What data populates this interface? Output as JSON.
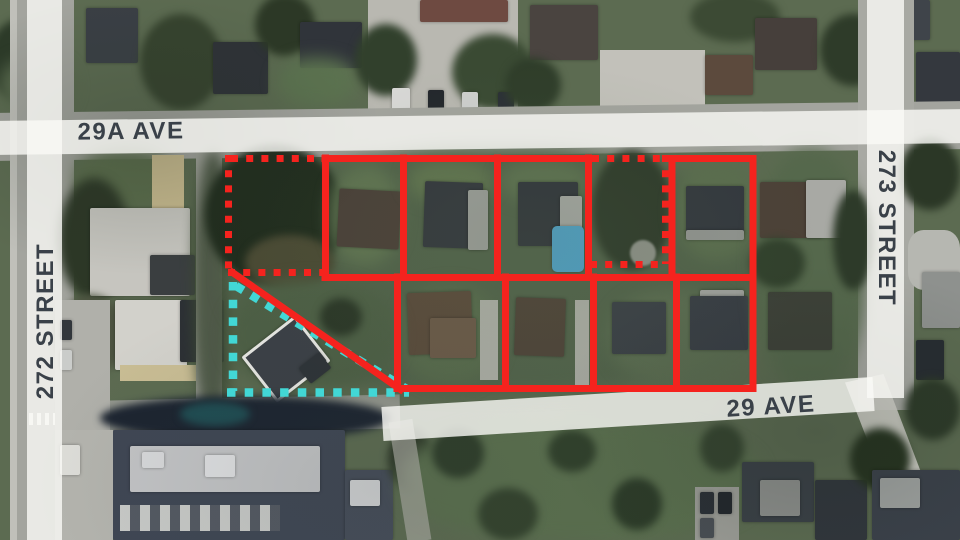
{
  "map": {
    "description": "Satellite aerial view of residential blocks with land-assembly lot outlines",
    "street_labels": {
      "top": "29A AVE",
      "left": "272 STREET",
      "right": "273 STREET",
      "bottom": "29 AVE"
    },
    "overlay": {
      "red_outline_color": "#f5231e",
      "cyan_outline_color": "#42d7d5",
      "solid_outlined_lots": 9,
      "red_dashed_lots": 2,
      "cyan_dashed_parcels": 1
    },
    "road_band_color": "#faf9f5",
    "label_text_color": "#3a4149"
  }
}
